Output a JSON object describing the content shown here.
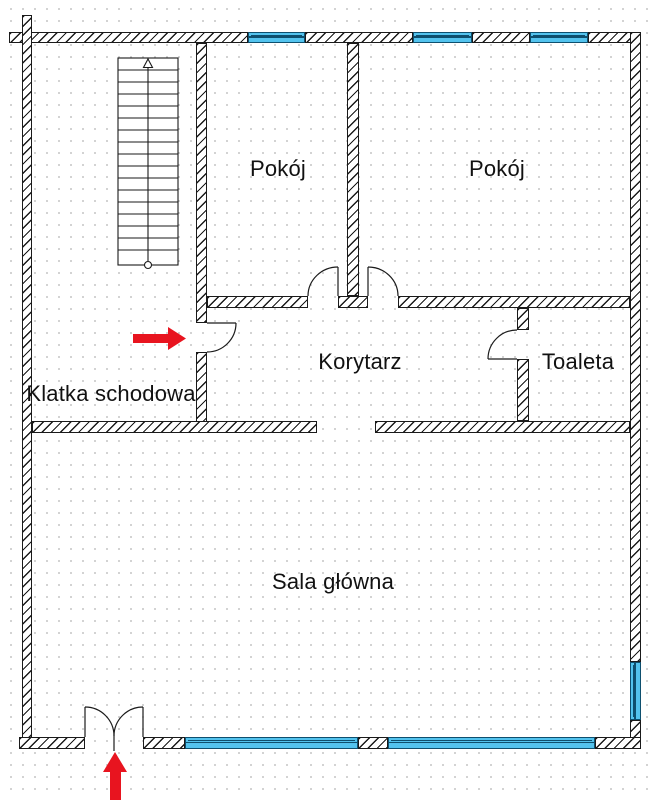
{
  "canvas": {
    "width": 656,
    "height": 800
  },
  "rooms": {
    "pokoj_left": {
      "label": "Pokój"
    },
    "pokoj_right": {
      "label": "Pokój"
    },
    "korytarz": {
      "label": "Korytarz"
    },
    "toaleta": {
      "label": "Toaleta"
    },
    "klatka_schodowa": {
      "label": "Klatka schodowa"
    },
    "sala_glowna": {
      "label": "Sala główna"
    }
  },
  "icons": {
    "side_entrance_arrow": "red-arrow-right",
    "main_entrance_arrow": "red-arrow-up",
    "stairs_symbol": "stair-run-with-up-direction-line"
  },
  "colors": {
    "wall_line": "#1a1a1a",
    "window_fill": "#53c3ee",
    "window_frame": "#0e4f6e",
    "arrow_red": "#e8141f",
    "grid_dot": "#c4c4c4",
    "text": "#111111"
  }
}
